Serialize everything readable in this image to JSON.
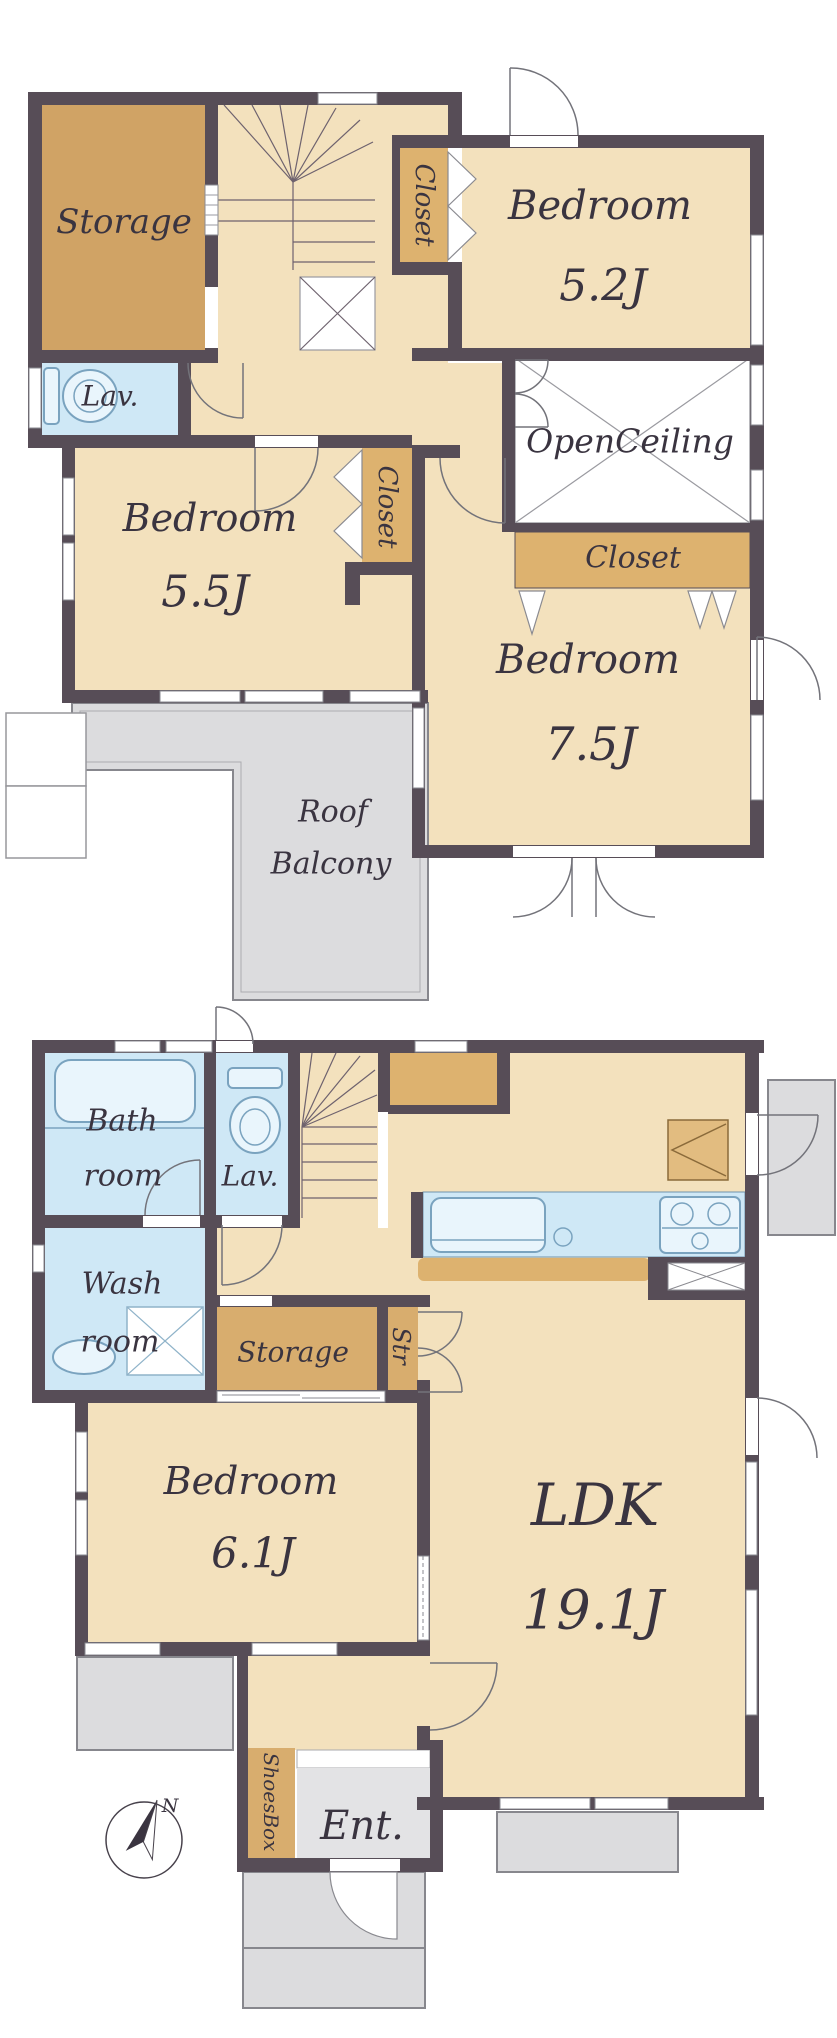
{
  "colors": {
    "wall": "#574d57",
    "floor": "#f3e1bd",
    "storage_fill": "#d0a365",
    "closet_fill": "#ddb26f",
    "wet_fill": "#cfe8f6",
    "outdoor_fill": "#dcdcde",
    "text": "#3a3440"
  },
  "floor2": {
    "storage_label": "Storage",
    "lav_label": "Lav.",
    "closet_top_label": "Closet",
    "closet_mid_label": "Closet",
    "closet_bottom_label": "Closet",
    "open_ceiling_label": "OpenCeiling",
    "bedroom_52": {
      "name": "Bedroom",
      "area": "5.2J"
    },
    "bedroom_55": {
      "name": "Bedroom",
      "area": "5.5J"
    },
    "bedroom_75": {
      "name": "Bedroom",
      "area": "7.5J"
    },
    "roof_balcony": {
      "line1": "Roof",
      "line2": "Balcony"
    }
  },
  "floor1": {
    "bath": {
      "line1": "Bath",
      "line2": "room"
    },
    "lav_label": "Lav.",
    "wash": {
      "line1": "Wash",
      "line2": "room"
    },
    "storage_label": "Storage",
    "str_label": "Str",
    "shoesbox_label": "ShoesBox",
    "entrance_label": "Ent.",
    "bedroom_61": {
      "name": "Bedroom",
      "area": "6.1J"
    },
    "ldk": {
      "name": "LDK",
      "area": "19.1J"
    },
    "compass_north": "N"
  }
}
